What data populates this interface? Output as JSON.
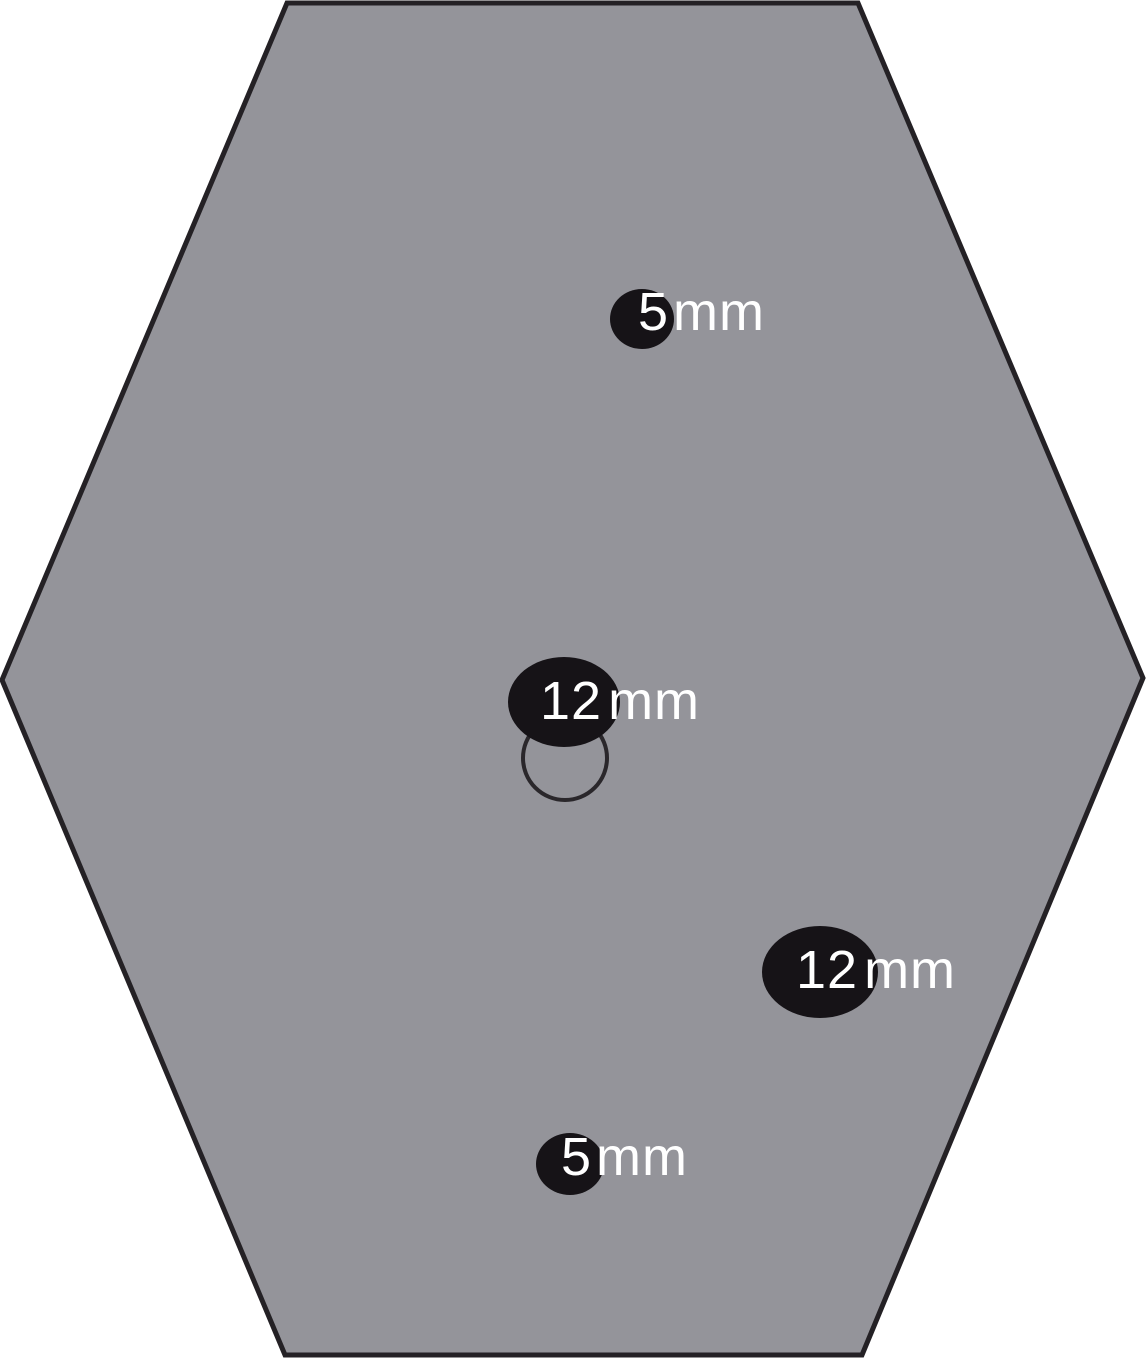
{
  "canvas": {
    "background": "#ffffff"
  },
  "body_outline": {
    "shape": "hexagon",
    "points": "287,3 858,3 1143,678 862,1355 285,1355 2,680",
    "fill": "#94949A",
    "stroke": "#242125",
    "stroke_width": 5
  },
  "landmark_circle": {
    "cx": 565,
    "cy": 758,
    "r": 42,
    "stroke": "#2A272B",
    "stroke_width": 4,
    "fill": "none"
  },
  "port_style": {
    "fill": "#161317",
    "label_color": "#ffffff"
  },
  "ports": [
    {
      "name": "upper-port",
      "size": "5",
      "unit": "mm",
      "cx": 642,
      "cy": 319,
      "rx": 32,
      "ry": 30,
      "label_x": 638,
      "label_y": 330
    },
    {
      "name": "center-port",
      "size": "12",
      "unit": "mm",
      "cx": 564,
      "cy": 702,
      "rx": 56,
      "ry": 45,
      "label_x": 540,
      "label_y": 719
    },
    {
      "name": "lower-right-port",
      "size": "12",
      "unit": "mm",
      "cx": 820,
      "cy": 972,
      "rx": 58,
      "ry": 46,
      "label_x": 796,
      "label_y": 988
    },
    {
      "name": "lower-center-port",
      "size": "5",
      "unit": "mm",
      "cx": 570,
      "cy": 1164,
      "rx": 34,
      "ry": 31,
      "label_x": 561,
      "label_y": 1175
    }
  ]
}
